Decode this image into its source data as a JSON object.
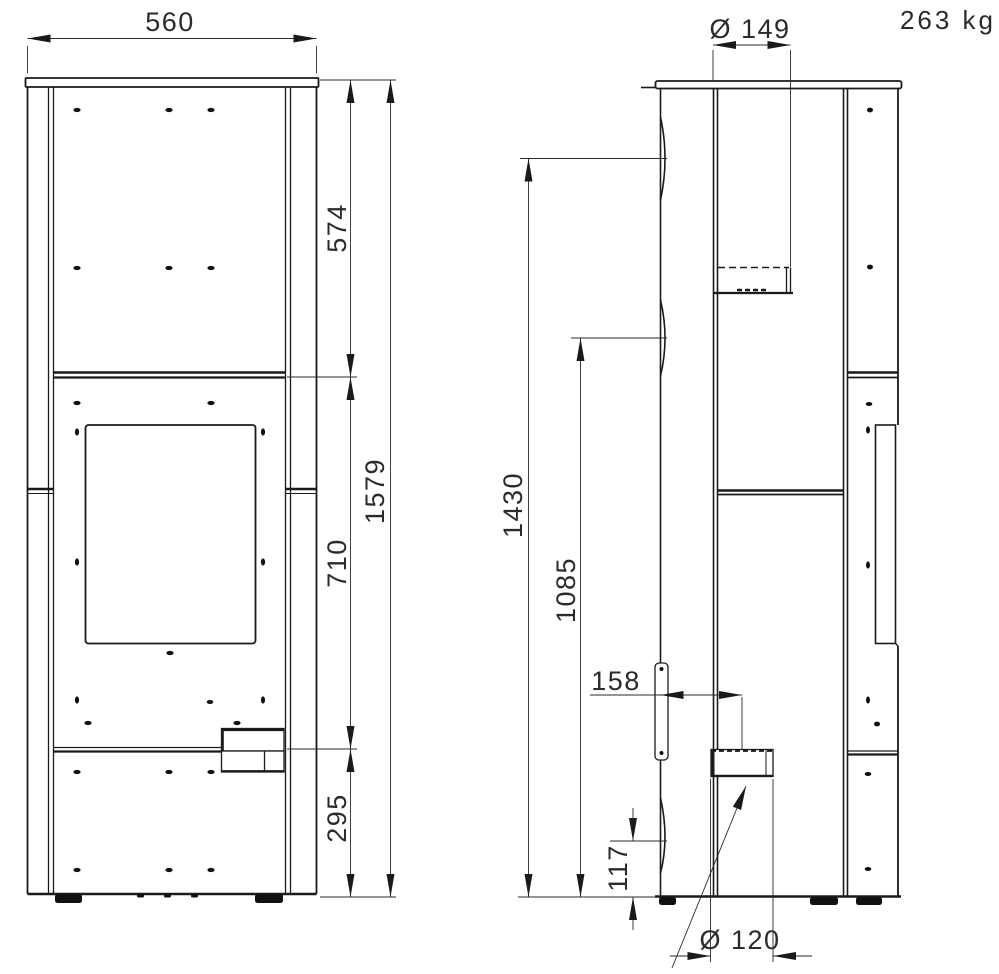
{
  "drawing": {
    "weight": "263 kg",
    "front_view": {
      "dims": {
        "width": "560",
        "upper_section": "574",
        "door_section": "710",
        "base_section": "295",
        "total_height": "1579"
      }
    },
    "side_view": {
      "dims": {
        "flue_diameter": "Ø 149",
        "rear_flue_height": "1430",
        "rear_outlet_height": "1085",
        "air_inlet_setback": "158",
        "air_inlet_height": "117",
        "air_inlet_diameter": "Ø 120"
      }
    },
    "dimensions_mm": {
      "width": 560,
      "upper_section": 574,
      "door_section": 710,
      "base_section": 295,
      "total_height": 1579,
      "flue_diameter": 149,
      "rear_flue_height": 1430,
      "rear_outlet_height": 1085,
      "air_inlet_setback": 158,
      "air_inlet_height": 117,
      "air_inlet_diameter": 120,
      "weight_kg": 263
    }
  }
}
